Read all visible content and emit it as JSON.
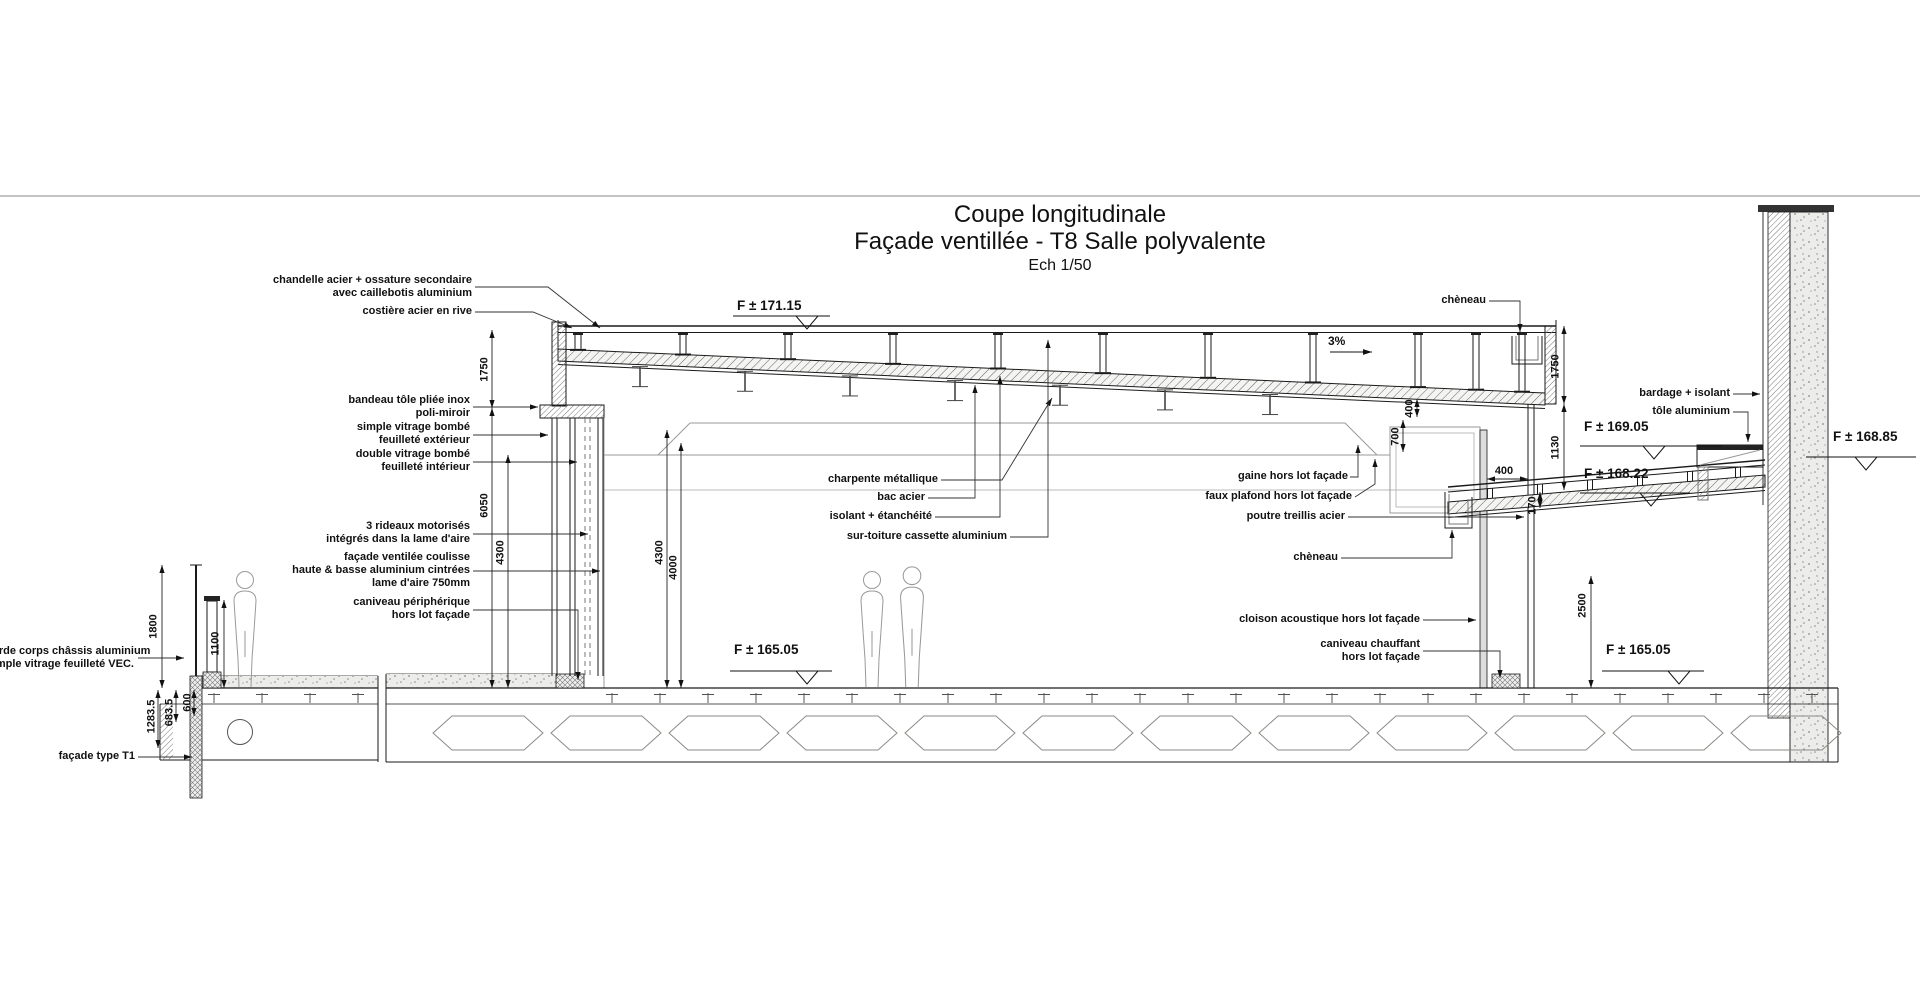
{
  "title": {
    "line1": "Coupe longitudinale",
    "line2": "Façade ventillée - T8 Salle polyvalente",
    "line3": "Ech 1/50"
  },
  "annotations": {
    "chandelle": [
      "chandelle acier + ossature secondaire",
      "avec caillebotis aluminium"
    ],
    "costiere": [
      "costière acier en rive"
    ],
    "bandeau": [
      "bandeau tôle pliée inox",
      "poli-miroir"
    ],
    "simple_vitrage": [
      "simple vitrage bombé",
      "feuilleté extérieur"
    ],
    "double_vitrage": [
      "double vitrage bombé",
      "feuilleté intérieur"
    ],
    "rideaux": [
      "3 rideaux motorisés",
      "intégrés dans la lame d'aire"
    ],
    "facade_ventilee": [
      "façade ventilée coulisse",
      "haute & basse aluminium cintrées",
      "lame d'aire 750mm"
    ],
    "caniveau_peripherique": [
      "caniveau périphérique",
      "hors lot façade"
    ],
    "garde_corps": [
      "garde corps châssis aluminium",
      "simple vitrage feuilleté VEC."
    ],
    "facade_t1": [
      "façade type T1"
    ],
    "charpente": [
      "charpente métallique"
    ],
    "bac_acier": [
      "bac acier"
    ],
    "isolant": [
      "isolant + étanchéité"
    ],
    "sur_toiture": [
      "sur-toiture cassette aluminium"
    ],
    "gaine": [
      "gaine hors lot façade"
    ],
    "faux_plafond": [
      "faux plafond hors lot façade"
    ],
    "poutre_treillis": [
      "poutre treillis acier"
    ],
    "cheneau_interieur": [
      "chèneau"
    ],
    "cloison": [
      "cloison acoustique hors lot façade"
    ],
    "caniveau_chauffant": [
      "caniveau chauffant",
      "hors lot façade"
    ],
    "cheneau_toiture": [
      "chèneau"
    ],
    "bardage": [
      "bardage + isolant"
    ],
    "tole_aluminium": [
      "tôle aluminium"
    ]
  },
  "levels": {
    "toiture": "F ± 171.15",
    "plancher": "F ± 165.05",
    "plancher_droit": "F ± 165.05",
    "terrasse_haut": "F ± 169.05",
    "terrasse_bas": "F ± 168.22",
    "terrasse_mur": "F ± 168.85"
  },
  "slope": "3%",
  "dims": {
    "d1750_g": "1750",
    "d6050": "6050",
    "d4300_g": "4300",
    "d4300_c": "4300",
    "d4000": "4000",
    "d1800": "1800",
    "d1100": "1100",
    "d600": "600",
    "d683": "683.5",
    "d1283": "1283.5",
    "d700": "700",
    "d400_plafond": "400",
    "d400_mur": "400",
    "d170": "170",
    "d1750_d": "1750",
    "d1130": "1130",
    "d2500": "2500"
  },
  "colors": {
    "line": "#1a1a1a",
    "detail": "#8a8a85",
    "background": "#ffffff"
  }
}
